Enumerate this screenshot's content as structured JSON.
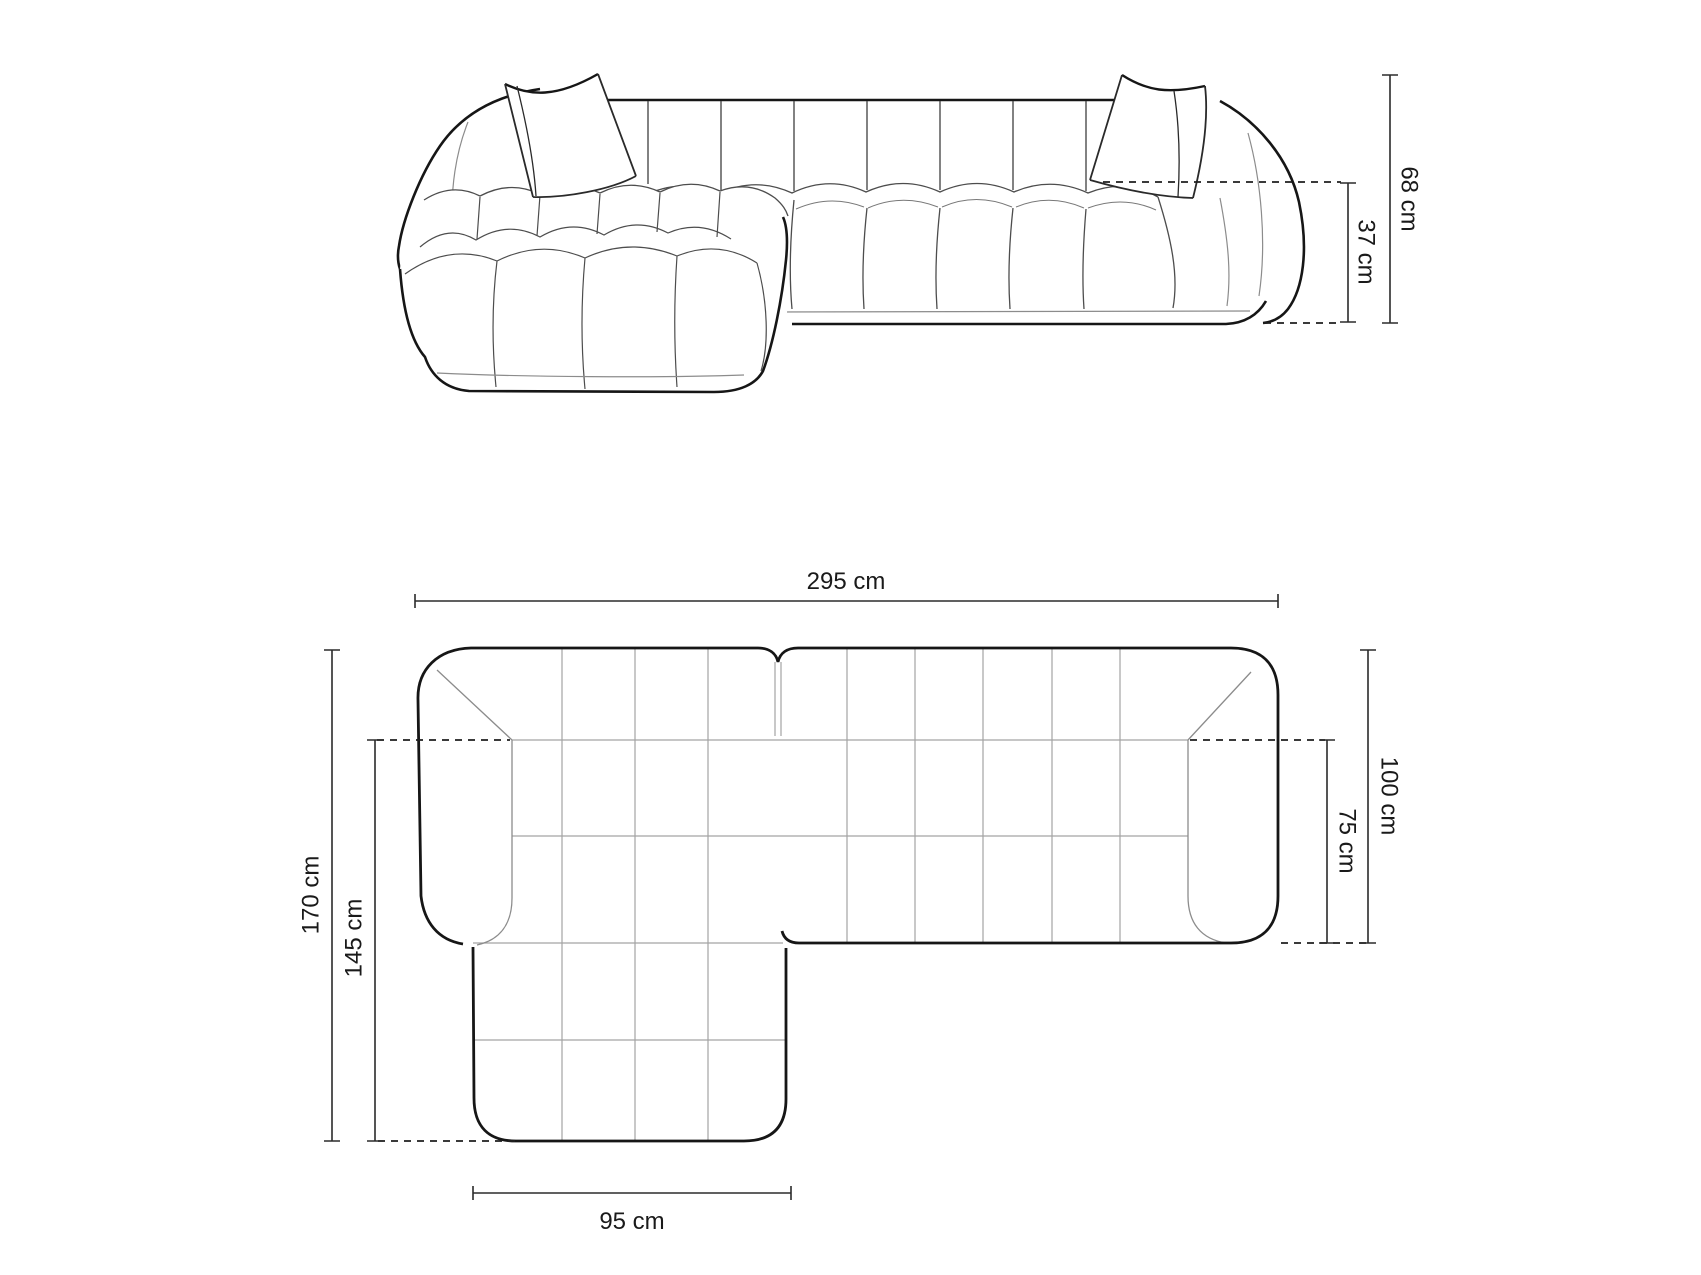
{
  "diagram": {
    "title": "corner-sofa-dimension-drawing",
    "background": "#ffffff",
    "outline_color": "#161616",
    "detail_color": "#4d4d4d",
    "grid_color": "#a3a3a3",
    "dimension_color": "#2b2b2b",
    "text_color": "#1a1a1a",
    "front_view": {
      "name": "front-elevation",
      "dims": {
        "total_height": "68 cm",
        "seat_height": "37 cm"
      }
    },
    "top_view": {
      "name": "top-plan",
      "dims": {
        "total_width": "295 cm",
        "total_depth": "170 cm",
        "chaise_inner_depth": "145 cm",
        "body_depth": "100 cm",
        "seat_inner_depth": "75 cm",
        "chaise_width": "95 cm"
      }
    }
  }
}
